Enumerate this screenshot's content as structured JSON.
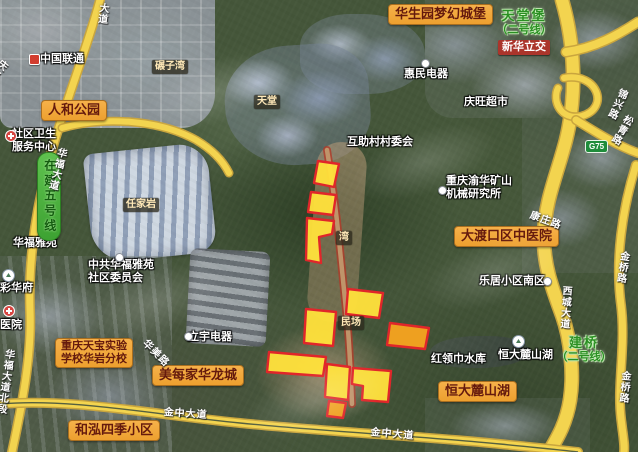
{
  "app": {
    "type": "satellite-map-view",
    "region": "重庆 大渡口 / 华岩片区"
  },
  "colors": {
    "parcel_fill": "#ffe13b",
    "parcel_fill_orange": "#f6a31f",
    "parcel_stroke": "#e0262a",
    "road_fill": "#f3d44f",
    "road_casing": "#c9a53e",
    "road_median": "#55603f",
    "construction_edge": "#b03a28",
    "construction_fill": "#bf946a",
    "poi_label_bg": "#f2a73d",
    "station_green": "#2a8f22"
  },
  "labels": [
    {
      "id": "label-huashengyuan-castle",
      "style": "yellow",
      "text": "华生园梦幻城堡",
      "x": 388,
      "y": 4
    },
    {
      "id": "label-renhe-park",
      "style": "yellow",
      "text": "人和公园",
      "x": 41,
      "y": 100
    },
    {
      "id": "label-dadukou-tcm-hospital",
      "style": "yellow",
      "text": "大渡口区中医院",
      "x": 454,
      "y": 226
    },
    {
      "id": "label-meimeijia-hualongcheng",
      "style": "yellow",
      "text": "美每家华龙城",
      "x": 152,
      "y": 365
    },
    {
      "id": "label-tianbao-school",
      "style": "yellow",
      "lines": [
        "重庆天宝实验",
        "学校华岩分校"
      ],
      "x": 55,
      "y": 338
    },
    {
      "id": "label-hehong-siji",
      "style": "yellow",
      "text": "和泓四季小区",
      "x": 68,
      "y": 420
    },
    {
      "id": "label-hengda-lushanhu-big",
      "style": "yellow",
      "text": "恒大麓山湖",
      "x": 438,
      "y": 381
    },
    {
      "id": "label-china-unicom",
      "style": "white",
      "text": "中国联通",
      "x": 40,
      "y": 53
    },
    {
      "id": "label-huimin-dianqi",
      "style": "white",
      "text": "惠民电器",
      "x": 404,
      "y": 68
    },
    {
      "id": "label-qingwang-supermarket",
      "style": "white",
      "text": "庆旺超市",
      "x": 464,
      "y": 96
    },
    {
      "id": "label-huzhucun-committee",
      "style": "white",
      "text": "互助村村委会",
      "x": 347,
      "y": 136
    },
    {
      "id": "label-community-health-center",
      "style": "white",
      "lines": [
        "社区卫生",
        "服务中心"
      ],
      "x": 12,
      "y": 128
    },
    {
      "id": "label-yuhua-mining-institute",
      "style": "white",
      "lines": [
        "重庆渝华矿山",
        "机械研究所"
      ],
      "x": 446,
      "y": 175
    },
    {
      "id": "label-leju-south",
      "style": "white",
      "text": "乐居小区南区",
      "x": 479,
      "y": 275
    },
    {
      "id": "label-huafu-yayuan",
      "style": "white",
      "text": "华福雅苑",
      "x": 13,
      "y": 237
    },
    {
      "id": "label-huafu-committee",
      "style": "white",
      "lines": [
        "中共华福雅苑",
        "社区委员会"
      ],
      "x": 88,
      "y": 259
    },
    {
      "id": "label-caihuafu",
      "style": "white",
      "text": "彩华府",
      "x": 0,
      "y": 282
    },
    {
      "id": "label-hospital",
      "style": "white",
      "text": "医院",
      "x": 0,
      "y": 319
    },
    {
      "id": "label-liyu-dianqi",
      "style": "white",
      "text": "立宇电器",
      "x": 188,
      "y": 331
    },
    {
      "id": "label-honglingjin-reservoir",
      "style": "white",
      "text": "红领巾水库",
      "x": 431,
      "y": 353
    },
    {
      "id": "label-hengda-lushanhu-small",
      "style": "white",
      "text": "恒大麓山湖",
      "x": 498,
      "y": 349
    },
    {
      "id": "label-nianziwan",
      "style": "dark",
      "text": "碾子湾",
      "x": 152,
      "y": 60
    },
    {
      "id": "label-tiantang",
      "style": "dark",
      "text": "天堂",
      "x": 254,
      "y": 95
    },
    {
      "id": "label-renjiayan",
      "style": "dark",
      "text": "任家岩",
      "x": 123,
      "y": 198
    },
    {
      "id": "label-wan",
      "style": "dark",
      "text": "湾",
      "x": 336,
      "y": 231
    },
    {
      "id": "label-minchang",
      "style": "dark",
      "text": "民场",
      "x": 338,
      "y": 316
    },
    {
      "id": "label-xinhua-interchange",
      "style": "red",
      "text": "新华立交",
      "x": 498,
      "y": 40
    },
    {
      "id": "label-station-tiantangbao",
      "style": "green",
      "lines": [
        "天堂堡",
        "（二号线）"
      ],
      "x": 490,
      "y": 9,
      "w": 68
    },
    {
      "id": "label-station-jianqiao",
      "style": "green",
      "lines": [
        "建桥",
        "（二号线）"
      ],
      "x": 551,
      "y": 336,
      "w": 66
    },
    {
      "id": "label-line5-under-construction",
      "style": "greenbanner",
      "text": "在建五号线",
      "x": 37,
      "y": 152
    },
    {
      "id": "label-road-huafu-north",
      "style": "road",
      "text": "华福大道北段",
      "x": 3,
      "y": 348,
      "vertical": true,
      "rotate": 8
    },
    {
      "id": "label-road-huafu",
      "style": "road",
      "text": "华福大道",
      "x": 56,
      "y": 146,
      "vertical": true,
      "rotate": 14
    },
    {
      "id": "label-road-dadao",
      "style": "road",
      "text": "大道",
      "x": 97,
      "y": 2,
      "vertical": true,
      "rotate": 6
    },
    {
      "id": "label-road-qinglu",
      "style": "road",
      "text": "庆路",
      "x": 0,
      "y": 56,
      "vertical": true,
      "rotate": 40
    },
    {
      "id": "label-road-kangzhuang",
      "style": "road",
      "text": "康庄路",
      "x": 532,
      "y": 210,
      "rotate": 20
    },
    {
      "id": "label-road-huamei",
      "style": "road",
      "text": "华美路",
      "x": 148,
      "y": 338,
      "rotate": 45
    },
    {
      "id": "label-road-xicheng",
      "style": "road",
      "text": "西城大道",
      "x": 560,
      "y": 285,
      "vertical": true,
      "rotate": 4
    },
    {
      "id": "label-road-jinqiao-north",
      "style": "road",
      "text": "金桥路",
      "x": 618,
      "y": 250,
      "vertical": true,
      "rotate": 8
    },
    {
      "id": "label-road-jinqiao-south",
      "style": "road",
      "text": "金桥路",
      "x": 619,
      "y": 370,
      "vertical": true,
      "rotate": 5
    },
    {
      "id": "label-road-jinxin",
      "style": "road",
      "text": "锦兴路",
      "x": 618,
      "y": 86,
      "vertical": true,
      "rotate": 25
    },
    {
      "id": "label-road-songqing",
      "style": "road",
      "text": "松青路",
      "x": 624,
      "y": 112,
      "vertical": true,
      "rotate": 30
    },
    {
      "id": "label-road-jinzhong-west",
      "style": "road",
      "text": "金中大道",
      "x": 164,
      "y": 407,
      "rotate": 4
    },
    {
      "id": "label-road-jinzhong-east",
      "style": "road",
      "text": "金中大道",
      "x": 371,
      "y": 427,
      "rotate": 5
    },
    {
      "id": "label-g75-shield",
      "style": "shield",
      "text": "G75",
      "x": 585,
      "y": 140
    }
  ],
  "icons": [
    {
      "id": "unicom-logo-icon",
      "type": "logo",
      "x": 29,
      "y": 54
    },
    {
      "id": "health-center-icon",
      "type": "red-badge",
      "x": 5,
      "y": 130
    },
    {
      "id": "huimin-poi-icon",
      "type": "dot",
      "x": 421,
      "y": 59
    },
    {
      "id": "institute-poi-icon",
      "type": "dot",
      "x": 438,
      "y": 186
    },
    {
      "id": "leju-poi-icon",
      "type": "dot",
      "x": 543,
      "y": 277
    },
    {
      "id": "hengda-poi-icon",
      "type": "poi-circle",
      "x": 512,
      "y": 335
    },
    {
      "id": "caihuafu-poi-icon",
      "type": "poi-circle",
      "x": 2,
      "y": 269
    },
    {
      "id": "hospital-poi-icon",
      "type": "red-badge",
      "x": 3,
      "y": 305
    },
    {
      "id": "liyu-poi-icon",
      "type": "dot",
      "x": 184,
      "y": 332
    },
    {
      "id": "committee-poi-icon",
      "type": "dot",
      "x": 115,
      "y": 253
    }
  ],
  "parcels": [
    {
      "id": "parcel-1",
      "color": "yellow",
      "points": [
        [
          318,
          161
        ],
        [
          339,
          164
        ],
        [
          334,
          187
        ],
        [
          314,
          183
        ]
      ]
    },
    {
      "id": "parcel-2",
      "color": "yellow",
      "points": [
        [
          311,
          192
        ],
        [
          336,
          195
        ],
        [
          333,
          215
        ],
        [
          308,
          212
        ]
      ]
    },
    {
      "id": "parcel-3",
      "color": "yellow",
      "points": [
        [
          307,
          218
        ],
        [
          334,
          221
        ],
        [
          332,
          234
        ],
        [
          319,
          237
        ],
        [
          321,
          263
        ],
        [
          306,
          260
        ]
      ]
    },
    {
      "id": "parcel-4",
      "color": "yellow",
      "points": [
        [
          348,
          289
        ],
        [
          383,
          293
        ],
        [
          379,
          318
        ],
        [
          346,
          314
        ]
      ]
    },
    {
      "id": "parcel-5",
      "color": "yellow",
      "points": [
        [
          306,
          309
        ],
        [
          336,
          312
        ],
        [
          333,
          346
        ],
        [
          304,
          343
        ]
      ]
    },
    {
      "id": "parcel-6",
      "color": "yellow",
      "points": [
        [
          269,
          352
        ],
        [
          326,
          357
        ],
        [
          323,
          376
        ],
        [
          267,
          372
        ]
      ]
    },
    {
      "id": "parcel-7",
      "color": "yellow",
      "points": [
        [
          327,
          364
        ],
        [
          350,
          367
        ],
        [
          348,
          400
        ],
        [
          325,
          397
        ]
      ]
    },
    {
      "id": "parcel-8",
      "color": "yellow",
      "points": [
        [
          353,
          368
        ],
        [
          391,
          371
        ],
        [
          388,
          402
        ],
        [
          362,
          400
        ],
        [
          363,
          386
        ],
        [
          352,
          384
        ]
      ]
    },
    {
      "id": "parcel-9",
      "color": "orange",
      "points": [
        [
          390,
          323
        ],
        [
          429,
          328
        ],
        [
          425,
          349
        ],
        [
          387,
          345
        ]
      ]
    },
    {
      "id": "parcel-10",
      "color": "orange",
      "points": [
        [
          329,
          401
        ],
        [
          346,
          403
        ],
        [
          343,
          418
        ],
        [
          327,
          416
        ]
      ]
    }
  ],
  "roads": [
    {
      "id": "road-huafu-avenue",
      "w": 7,
      "path": "M 100 0 C 88 45 68 95 52 150 C 38 198 28 255 30 310 C 32 355 22 405 12 452"
    },
    {
      "id": "road-huafu-branch",
      "w": 6,
      "path": "M 62 128 C 105 116 160 120 196 140 C 213 150 223 161 229 173"
    },
    {
      "id": "road-highway-xicheng",
      "w": 12,
      "path": "M 562 0 C 575 45 577 95 566 140 C 557 175 545 200 544 235 C 543 265 553 290 562 315 C 571 340 574 375 570 400 C 566 425 556 440 549 452"
    },
    {
      "id": "road-ramp-northeast",
      "w": 8,
      "path": "M 566 52 C 595 48 618 35 638 22"
    },
    {
      "id": "road-ramp-loop",
      "w": 6,
      "path": "M 564 78 C 598 72 610 108 582 116 C 560 121 552 100 558 88"
    },
    {
      "id": "road-ramp-east",
      "w": 7,
      "path": "M 576 120 C 600 135 620 147 638 153"
    },
    {
      "id": "road-jinqiao",
      "w": 7,
      "path": "M 636 165 C 622 210 615 260 621 305 C 626 345 617 385 621 418 C 623 436 625 445 624 452"
    },
    {
      "id": "road-jinzhong-avenue",
      "w": 7,
      "median": true,
      "path": "M 0 404 C 70 398 150 414 240 423 C 330 432 420 436 500 444 C 540 448 562 450 578 452"
    }
  ],
  "construction_road": {
    "id": "road-under-construction",
    "path": "M 327 150 C 332 180 336 210 339 240 C 342 270 345 300 348 330 C 350 355 351 380 352 404"
  }
}
